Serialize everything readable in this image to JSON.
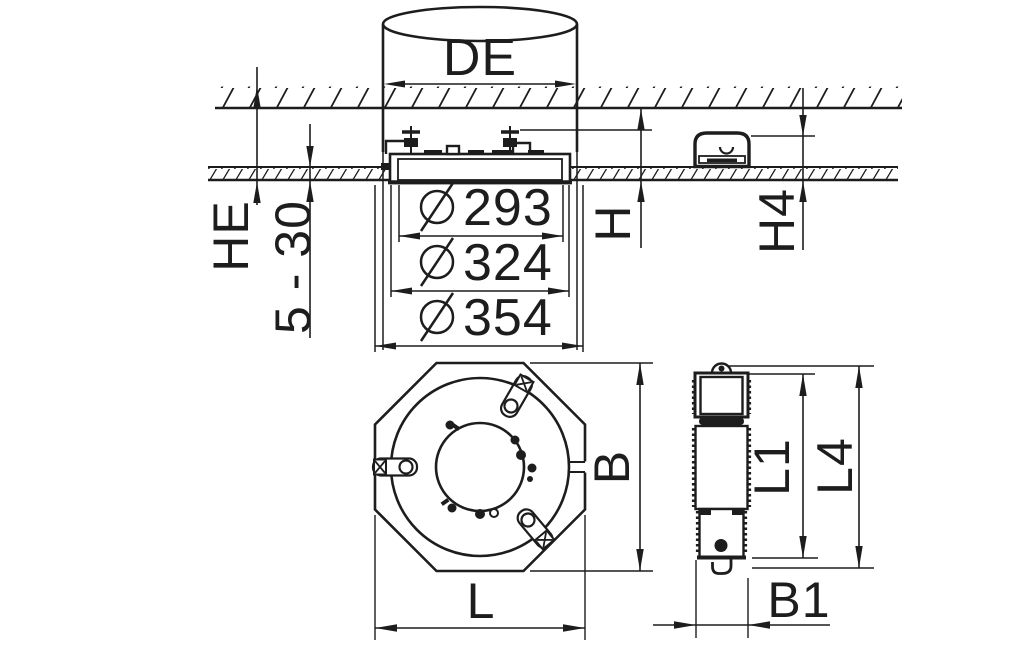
{
  "drawing": {
    "type": "technical-dimension-drawing",
    "description": "Recessed ceiling luminaire installation drawing with section view, octagonal plan view and side view of control gear box",
    "colors": {
      "line": "#1d1d1d",
      "background": "#ffffff"
    },
    "diameter_symbol": "Ø"
  },
  "section": {
    "cylinder_diameter": "DE",
    "recess_height": "HE",
    "ceiling_thickness_range": "5 - 30",
    "cutout_diameters": [
      "293",
      "324",
      "354"
    ],
    "height_clearance": "H",
    "box_height_clearance": "H4"
  },
  "plan": {
    "width": "B",
    "length": "L"
  },
  "side": {
    "body_length": "L1",
    "overall_length": "L4",
    "width": "B1"
  }
}
